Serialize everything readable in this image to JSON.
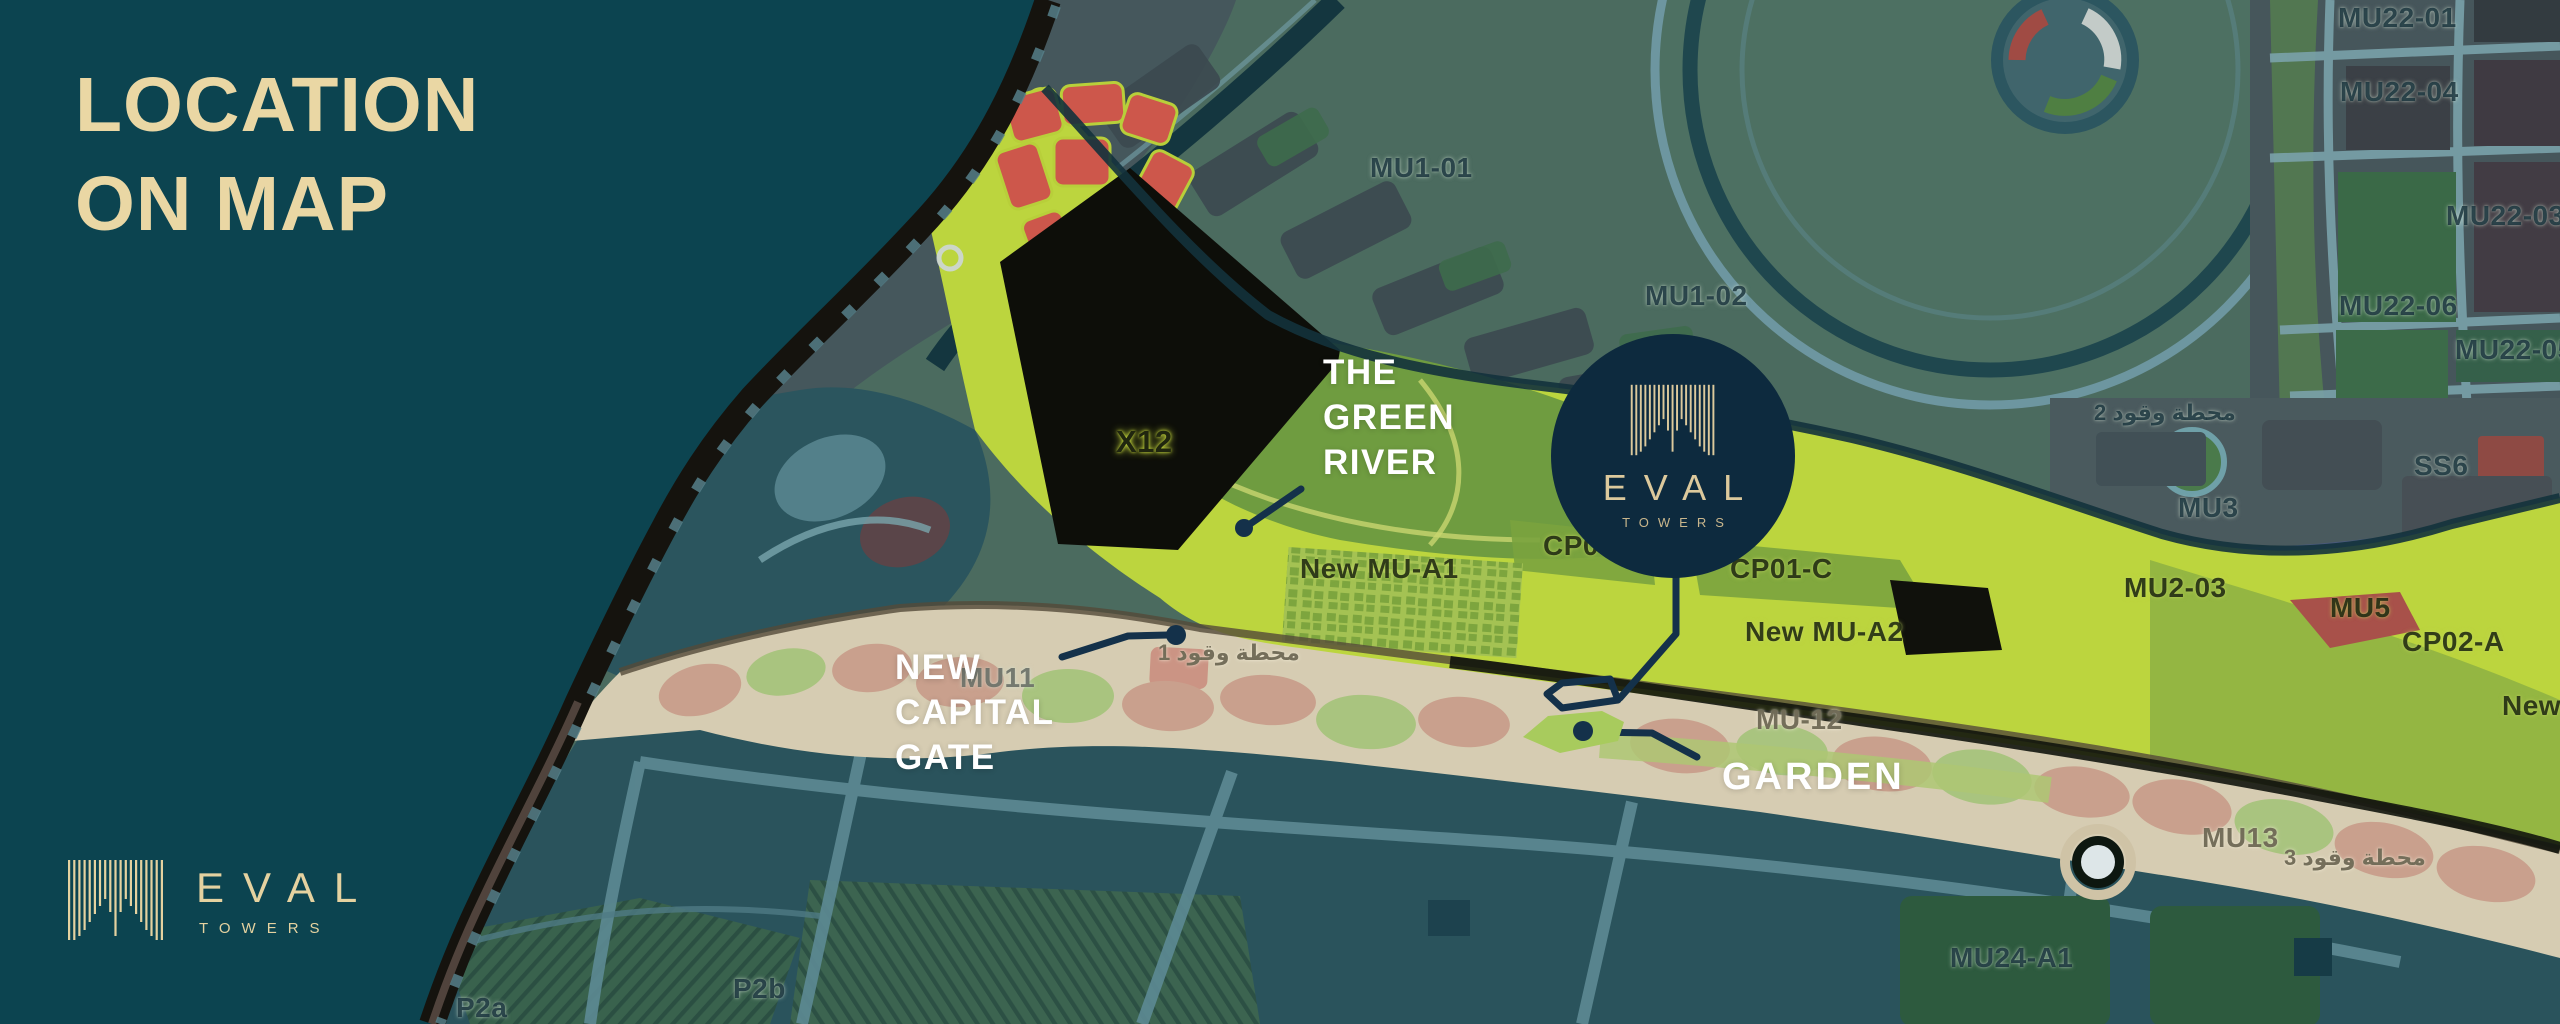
{
  "colors": {
    "background_teal": "#0C4450",
    "accent_gold": "#EAD7A4",
    "badge_navy": "#0D2A3E",
    "leader_navy": "#14314A",
    "river_green": "#BCD53E",
    "boulevard_beige": "#D6CCB2",
    "annotation_white": "#FFFFFF"
  },
  "header": {
    "title_line1": "LOCATION",
    "title_line2": "ON MAP"
  },
  "brand": {
    "name": "EVAL",
    "subtitle": "TOWERS"
  },
  "badge": {
    "name": "EVAL",
    "subtitle": "TOWERS"
  },
  "annotations": {
    "green_river": {
      "l1": "THE",
      "l2": "GREEN",
      "l3": "RIVER"
    },
    "capital_gate": {
      "l1": "NEW",
      "l2": "CAPITAL",
      "l3": "GATE"
    },
    "garden": {
      "label": "GARDEN"
    }
  },
  "map_labels": [
    {
      "id": "mu22-01",
      "text": "MU22-01"
    },
    {
      "id": "mu22-04",
      "text": "MU22-04"
    },
    {
      "id": "mu22-03",
      "text": "MU22-03"
    },
    {
      "id": "mu22-06",
      "text": "MU22-06"
    },
    {
      "id": "mu22-05",
      "text": "MU22-05"
    },
    {
      "id": "ss6",
      "text": "SS6"
    },
    {
      "id": "mu3",
      "text": "MU3"
    },
    {
      "id": "fuel-station-2",
      "text": "محطة وقود 2"
    },
    {
      "id": "mu1-01",
      "text": "MU1-01"
    },
    {
      "id": "mu1-02",
      "text": "MU1-02"
    },
    {
      "id": "mu2-03",
      "text": "MU2-03"
    },
    {
      "id": "mu5",
      "text": "MU5"
    },
    {
      "id": "cp02-a",
      "text": "CP02-A"
    },
    {
      "id": "x12",
      "text": "X12"
    },
    {
      "id": "new-mu-a1",
      "text": "New MU-A1"
    },
    {
      "id": "cp0-partial",
      "text": "CP0"
    },
    {
      "id": "cp01-c",
      "text": "CP01-C"
    },
    {
      "id": "new-mu-a2",
      "text": "New MU-A2"
    },
    {
      "id": "mu-12",
      "text": "MU-12"
    },
    {
      "id": "mu11",
      "text": "MU11"
    },
    {
      "id": "fuel-station-1",
      "text": "محطة وقود 1"
    },
    {
      "id": "mu13",
      "text": "MU13"
    },
    {
      "id": "fuel-station-3",
      "text": "محطة وقود 3"
    },
    {
      "id": "mu24-a1",
      "text": "MU24-A1"
    },
    {
      "id": "p2a",
      "text": "P2a"
    },
    {
      "id": "p2b",
      "text": "P2b"
    },
    {
      "id": "new-edge",
      "text": "New"
    }
  ]
}
